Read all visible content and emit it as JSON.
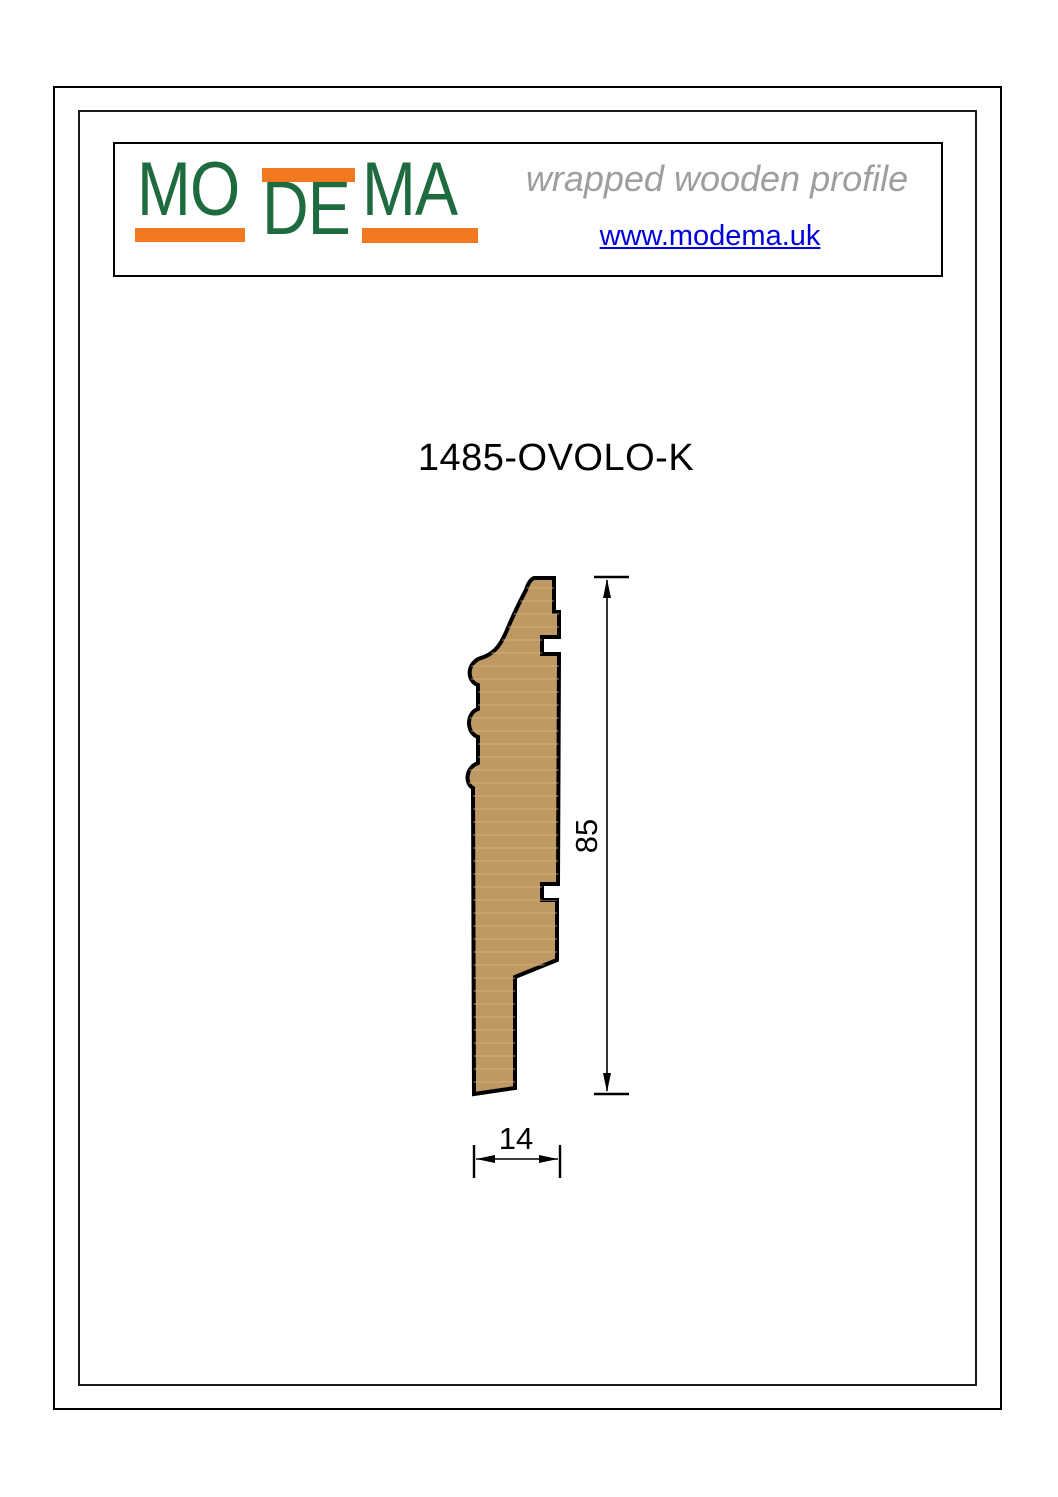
{
  "header": {
    "logo": {
      "part1": "MO",
      "part2": "DE",
      "part3": "MA",
      "green": "#1d6b3e",
      "orange": "#f2791f"
    },
    "tagline": "wrapped wooden profile",
    "tagline_color": "#9e9e9e",
    "website": "www.modema.uk",
    "link_color": "#0000dd"
  },
  "main": {
    "title": "1485-OVOLO-K"
  },
  "drawing": {
    "wood_fill": "#bf9963",
    "grain_color": "#d6b183",
    "outline_color": "#000000",
    "profile_path": "M 534 578 L 554 578 L 554 612 L 559 612 L 559 637 L 542 637 L 542 654 L 559 654 L 558 884 L 542 884 L 542 900 L 557 900 L 557 960 L 515 977 L 515 1088 L 474 1094 L 473 788 C 465 784 465 768 478 763 L 478 737 C 466 733 466 713 478 709 L 478 685 C 466 681 466 661 484 657 C 496 652 501 644 507 630 C 515 611 519 603 526 590 Q 529 580 534 578 Z",
    "dimensions": {
      "height_label": "85",
      "width_label": "14"
    }
  }
}
